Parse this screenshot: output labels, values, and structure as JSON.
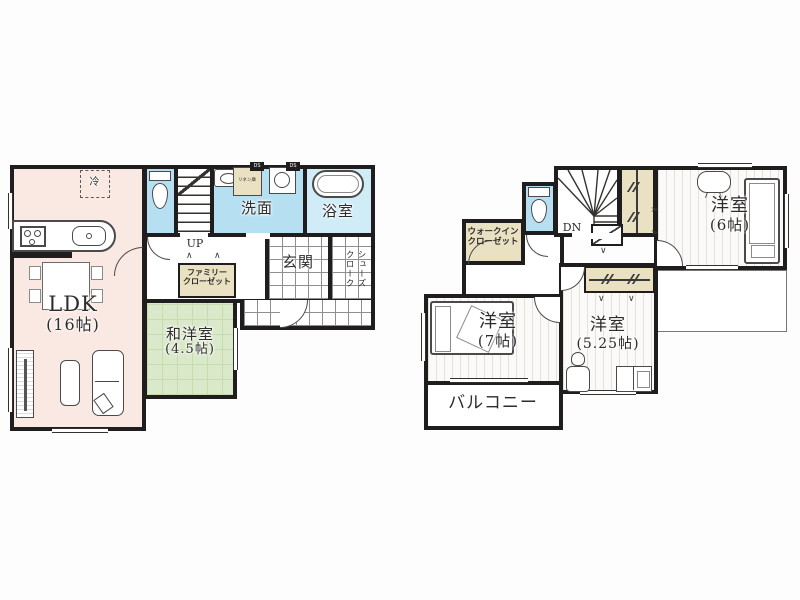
{
  "colors": {
    "wall": "#201d1e",
    "ldk_pink": "#f9e9e2",
    "water_blue": "#b6dff1",
    "bath_blue": "#cfecf7",
    "tatami_green": "#dbe9cb",
    "closet_tan": "#eae1c2",
    "line_gray": "#4a4a4a"
  },
  "floor1": {
    "ldk_name": "LDK",
    "ldk_size": "(16帖)",
    "washitsu_name": "和洋室",
    "washitsu_size": "(4.5帖)",
    "senmen_label": "洗面",
    "bath_label": "浴室",
    "genkan_label": "玄関",
    "family_closet_line1": "ファミリー",
    "family_closet_line2": "クローゼット",
    "shoes_cloak_col_right": "シューズ",
    "shoes_cloak_col_left": "クローク",
    "linen_label": "リネン庫",
    "fridge_label": "冷",
    "stairs_label": "UP",
    "duct_label": "DS"
  },
  "floor2": {
    "bed6_name": "洋室",
    "bed6_size": "(6帖)",
    "bed7_name": "洋室",
    "bed7_size": "(7帖)",
    "bed525_name": "洋室",
    "bed525_size": "(5.25帖)",
    "balcony_label": "バルコニー",
    "wic_line1": "ウォークイン",
    "wic_line2": "クローゼット",
    "stairs_label": "DN"
  },
  "marks": {
    "fold_up": "∧",
    "fold_down": "∨"
  }
}
